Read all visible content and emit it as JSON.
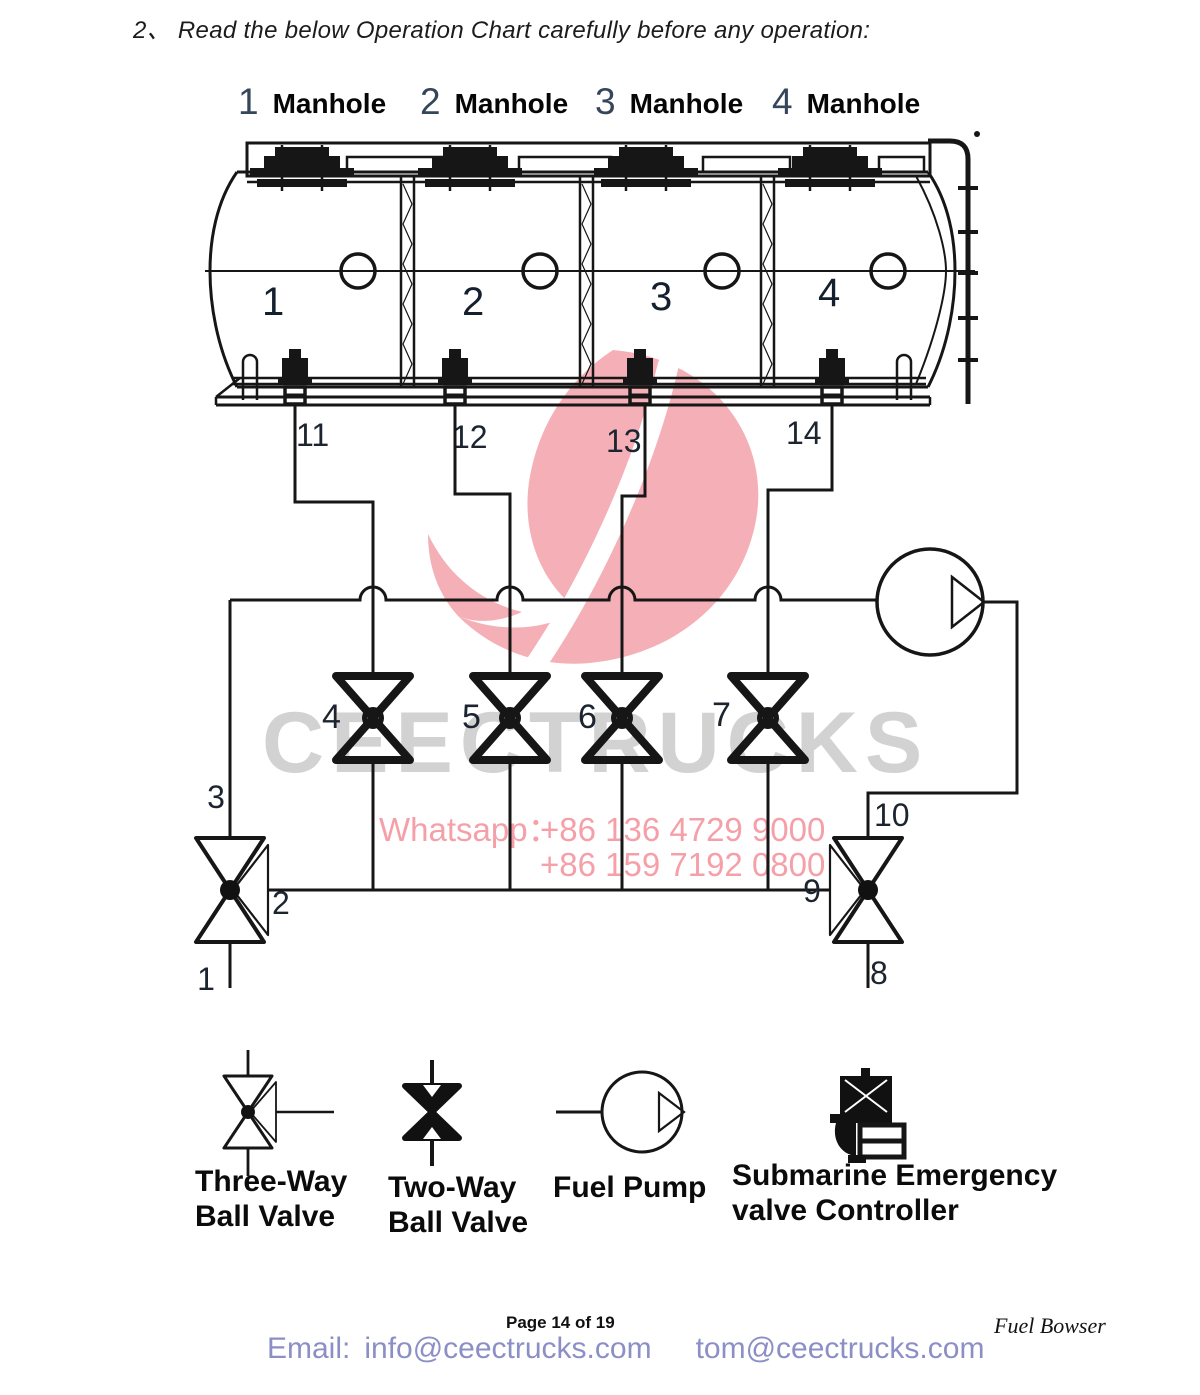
{
  "header": {
    "instruction": "2、 Read the below Operation Chart carefully before any operation:"
  },
  "manholes": [
    {
      "num": "1",
      "label": "Manhole"
    },
    {
      "num": "2",
      "label": "Manhole"
    },
    {
      "num": "3",
      "label": "Manhole"
    },
    {
      "num": "4",
      "label": "Manhole"
    }
  ],
  "tank": {
    "compartments": [
      "1",
      "2",
      "3",
      "4"
    ],
    "discharge_labels": [
      "11",
      "12",
      "13",
      "14"
    ]
  },
  "valves": {
    "two_way": [
      "4",
      "5",
      "6",
      "7"
    ],
    "left_three_way": {
      "top": "3",
      "middle": "2",
      "bottom": "1"
    },
    "right_three_way": {
      "top": "10",
      "middle": "9",
      "bottom": "8"
    }
  },
  "watermark": {
    "brand": "CEECTRUCKS",
    "whatsapp_label": "Whatsapp：",
    "phone_1": "+86 136 4729 9000",
    "phone_2": "+86 159 7192 0800"
  },
  "legend": {
    "items": [
      {
        "name": "three-way-ball-valve",
        "line1": "Three-Way",
        "line2": "Ball Valve"
      },
      {
        "name": "two-way-ball-valve",
        "line1": "Two-Way",
        "line2": "Ball Valve"
      },
      {
        "name": "fuel-pump",
        "line1": "Fuel Pump",
        "line2": ""
      },
      {
        "name": "submarine-emergency-valve-controller",
        "line1": "Submarine Emergency",
        "line2": "valve Controller"
      }
    ]
  },
  "footer": {
    "page_label": "Page 14 of  19",
    "email_label": "Email:",
    "email_1": "info@ceectrucks.com",
    "email_2": "tom@ceectrucks.com",
    "doc_label": "Fuel Bowser"
  },
  "colors": {
    "line": "#161616",
    "logo_pink": "#f3a6ad",
    "watermark_gray": "#d2d2d2",
    "whatsapp_pink": "#f5a0a8",
    "email_purple": "#8b8fc5"
  }
}
